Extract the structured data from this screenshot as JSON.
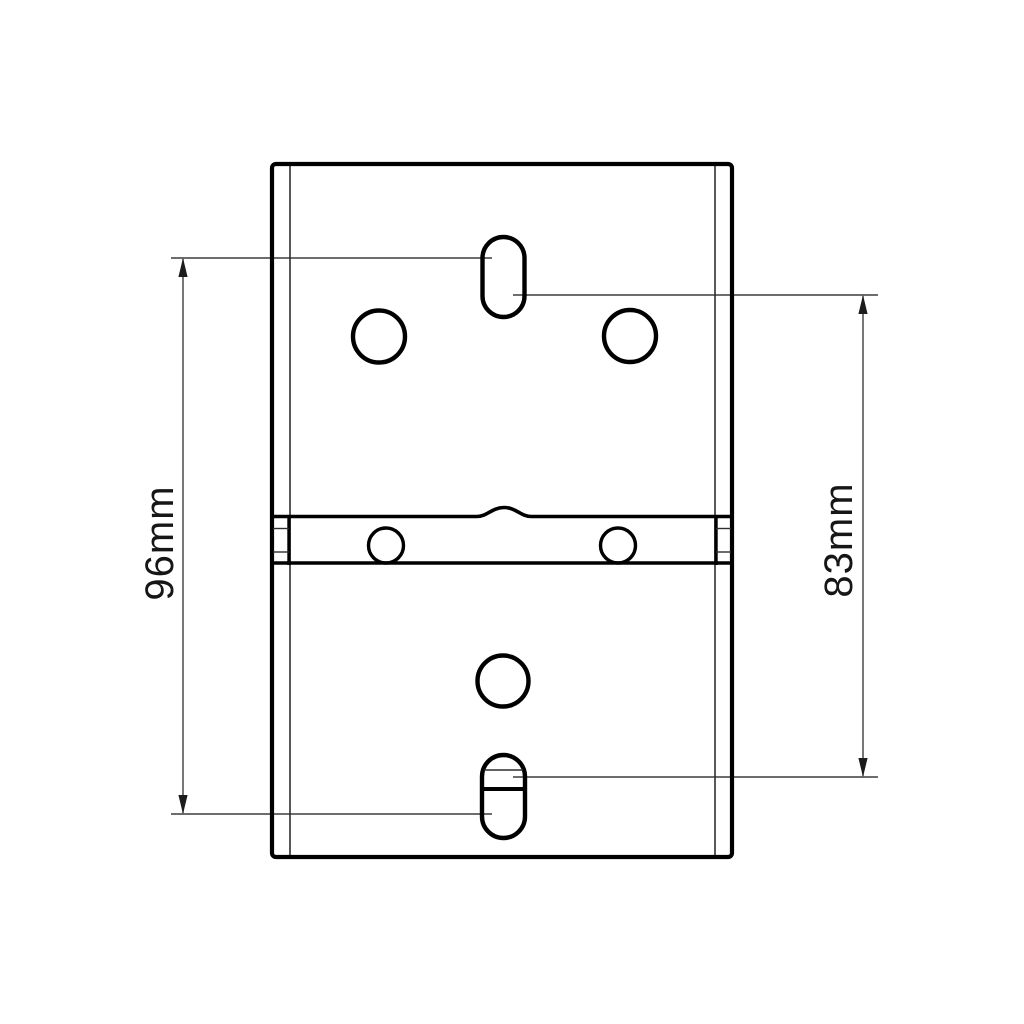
{
  "drawing": {
    "kind": "technical dimension drawing of mounting plate rear view",
    "dimensions": [
      {
        "label": "96mm"
      },
      {
        "label": "83mm"
      }
    ],
    "colors": {
      "background": "#ffffff",
      "outline": "#000000",
      "dimension_line": "#3d3d3d",
      "text": "#161616"
    }
  }
}
